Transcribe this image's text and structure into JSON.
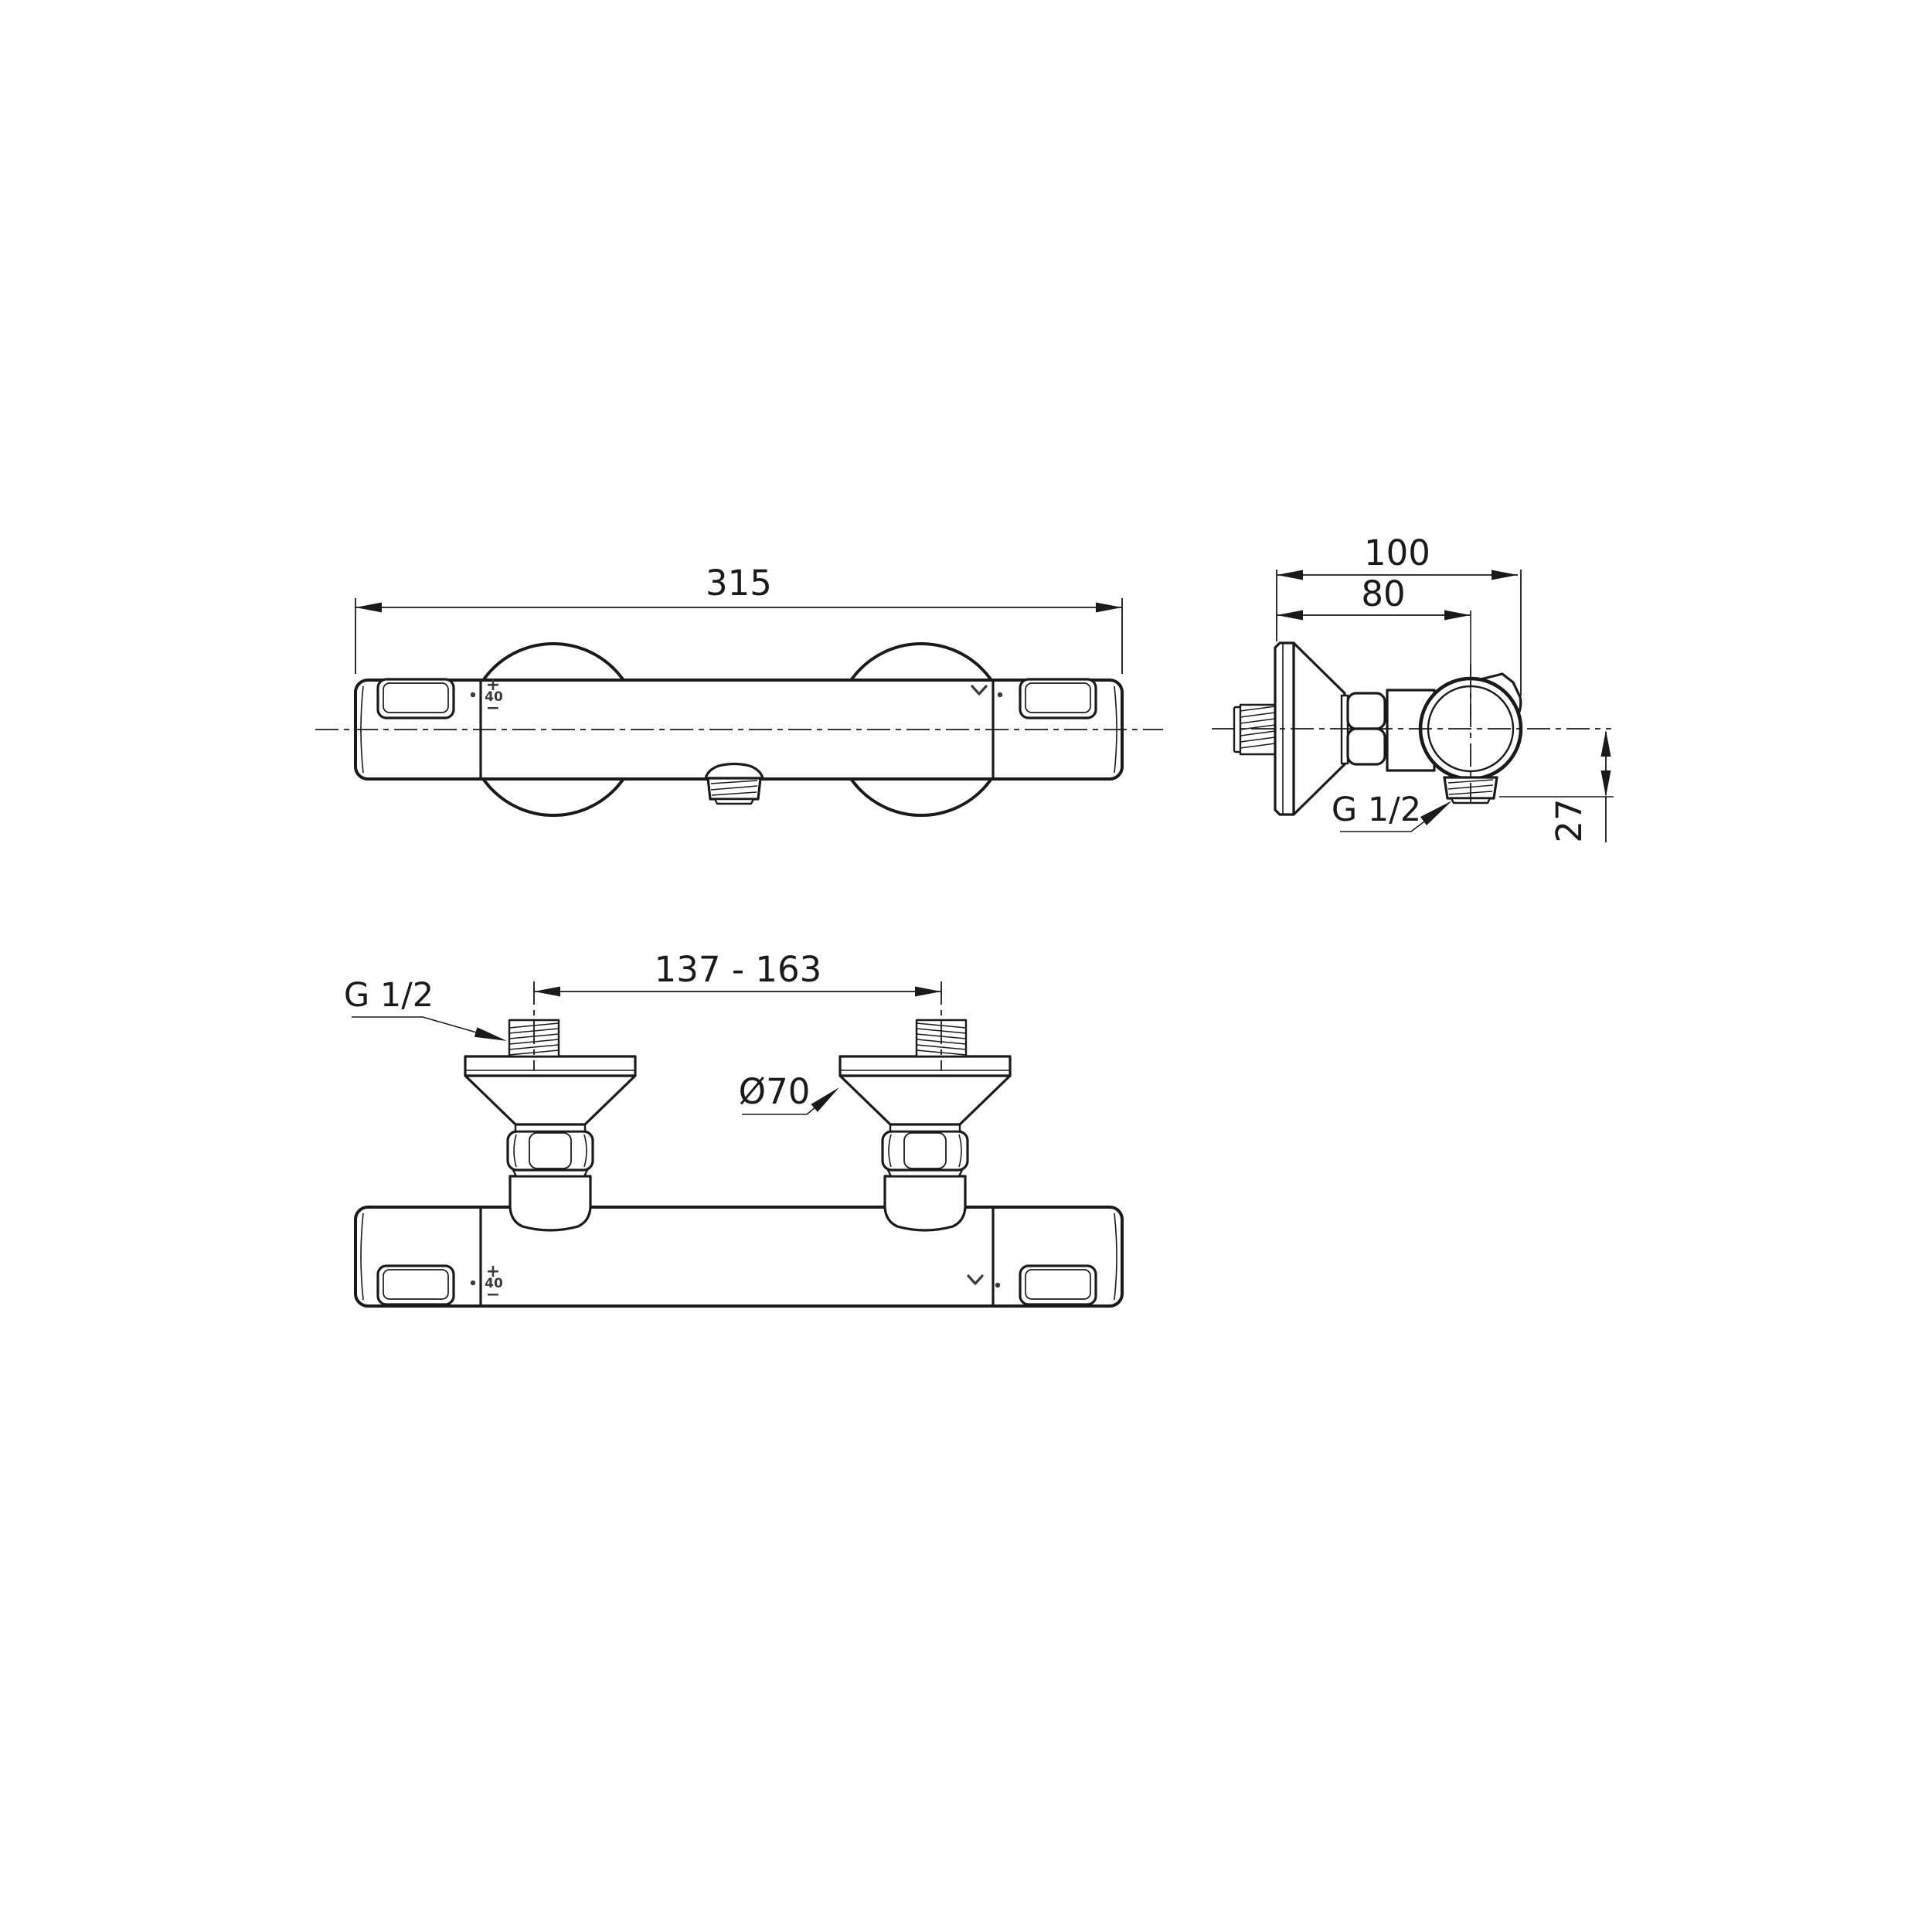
{
  "drawing": {
    "front_view": {
      "length_dim": "315"
    },
    "side_view": {
      "overall_depth_dim": "100",
      "wall_to_center_dim": "80",
      "outlet_drop_dim": "27",
      "outlet_thread_label": "G 1/2"
    },
    "top_view": {
      "inlet_spacing_dim": "137 - 163",
      "inlet_thread_label": "G 1/2",
      "escutcheon_diameter_label": "Ø70"
    },
    "handle_marks": {
      "plus": "+",
      "temperature_stop": "40",
      "minus": "−"
    },
    "icons": {
      "diverter": "chevron-down"
    },
    "colors": {
      "line": "#1a1a1a",
      "marks": "#3a3a3a",
      "background": "#ffffff"
    }
  }
}
